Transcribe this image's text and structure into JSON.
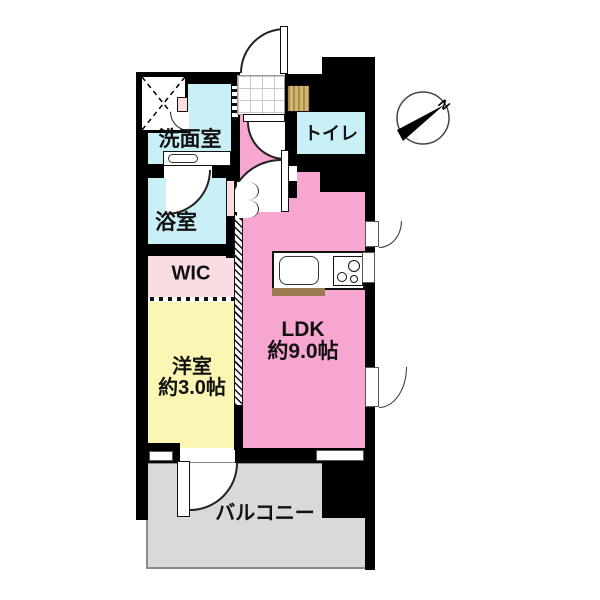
{
  "compass": {
    "north_label": "N"
  },
  "rooms": {
    "washroom": {
      "label": "洗面室"
    },
    "bathroom": {
      "label": "浴室"
    },
    "wic": {
      "label": "WIC"
    },
    "western_room": {
      "label": "洋室",
      "size": "約3.0帖"
    },
    "ldk": {
      "label": "LDK",
      "size": "約9.0帖"
    },
    "toilet": {
      "label": "トイレ"
    },
    "balcony": {
      "label": "バルコニー"
    }
  },
  "colors": {
    "wall": "#000000",
    "water_rooms": "#c9f0f6",
    "ldk_pink": "#f7a6d1",
    "wic_pink": "#fadde2",
    "western_room_yellow": "#fbf6b4",
    "balcony_gray": "#d9d9d9",
    "shoe_cabinet_tan": "#d3b671",
    "kitchen_counter_edge": "#9c7b50"
  }
}
